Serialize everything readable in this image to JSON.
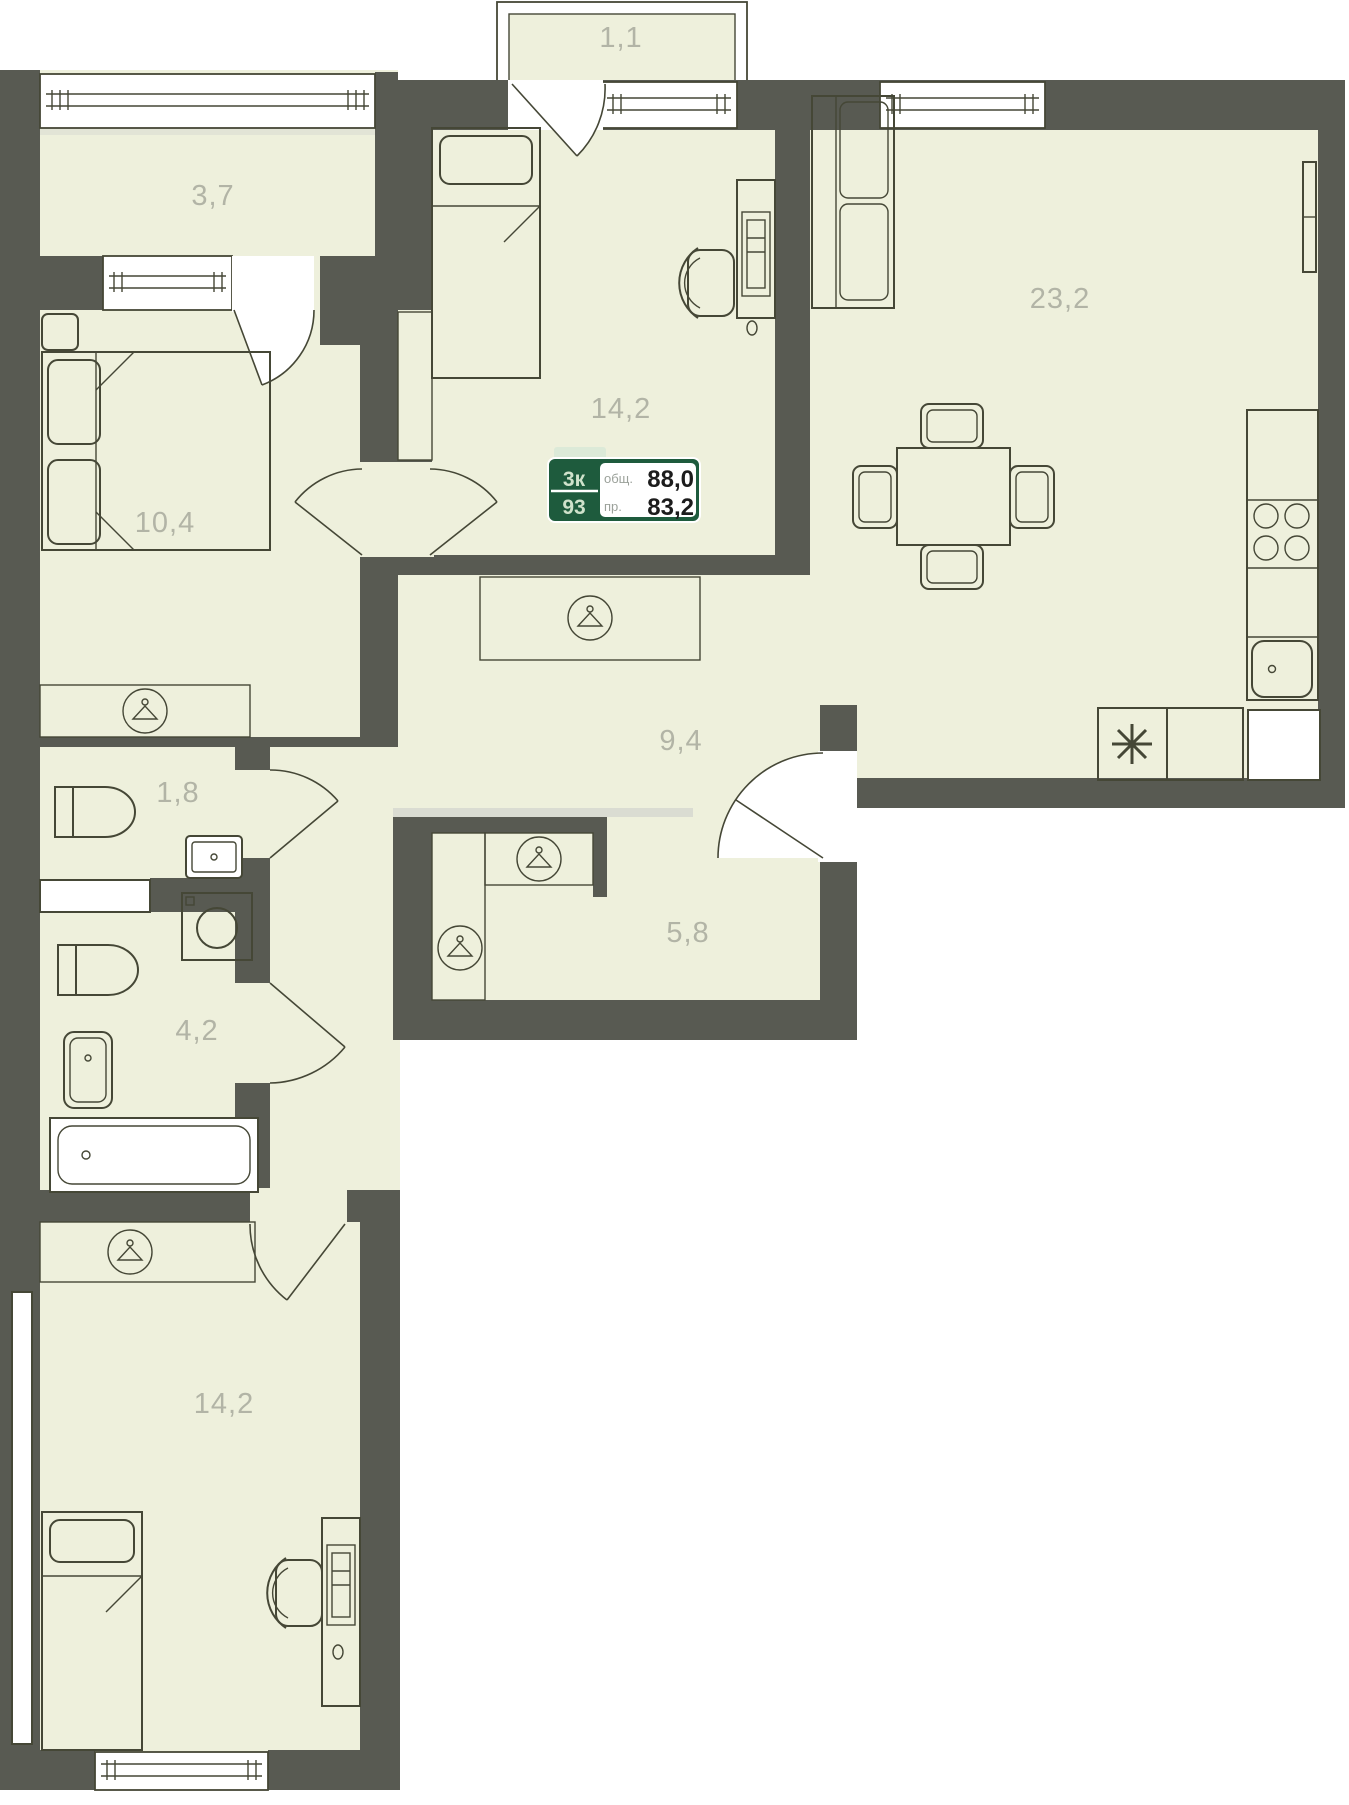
{
  "plan": {
    "title": "apartment floor plan",
    "rooms": [
      {
        "id": "balcony-top-left",
        "kind": "balcony",
        "area": "3,7"
      },
      {
        "id": "balcony-top",
        "kind": "balcony",
        "area": "1,1"
      },
      {
        "id": "bedroom-top",
        "kind": "bedroom",
        "area": "14,2"
      },
      {
        "id": "living-kitchen",
        "kind": "living room with kitchen",
        "area": "23,2"
      },
      {
        "id": "bedroom-left",
        "kind": "bedroom",
        "area": "10,4"
      },
      {
        "id": "hallway",
        "kind": "hallway",
        "area": "9,4"
      },
      {
        "id": "wc",
        "kind": "toilet",
        "area": "1,8"
      },
      {
        "id": "wardrobe-hall",
        "kind": "entrance hall / wardrobe",
        "area": "5,8"
      },
      {
        "id": "bathroom",
        "kind": "bathroom",
        "area": "4,2"
      },
      {
        "id": "bedroom-bottom",
        "kind": "bedroom",
        "area": "14,2"
      }
    ],
    "badge": {
      "type_code": "3к",
      "unit_number": "93",
      "total_label": "общ.",
      "total_value": "88,0",
      "living_label": "пр.",
      "living_value": "83,2"
    },
    "colors": {
      "wall": "#585a52",
      "floor": "#eef0dc",
      "line": "#454736",
      "label": "#b2b4a6",
      "badge_green": "#1e5b3d",
      "badge_tab": "#dcead8"
    },
    "icons": [
      "hanger-icon",
      "asterisk-appliance-icon",
      "stove-burners-icon"
    ]
  }
}
